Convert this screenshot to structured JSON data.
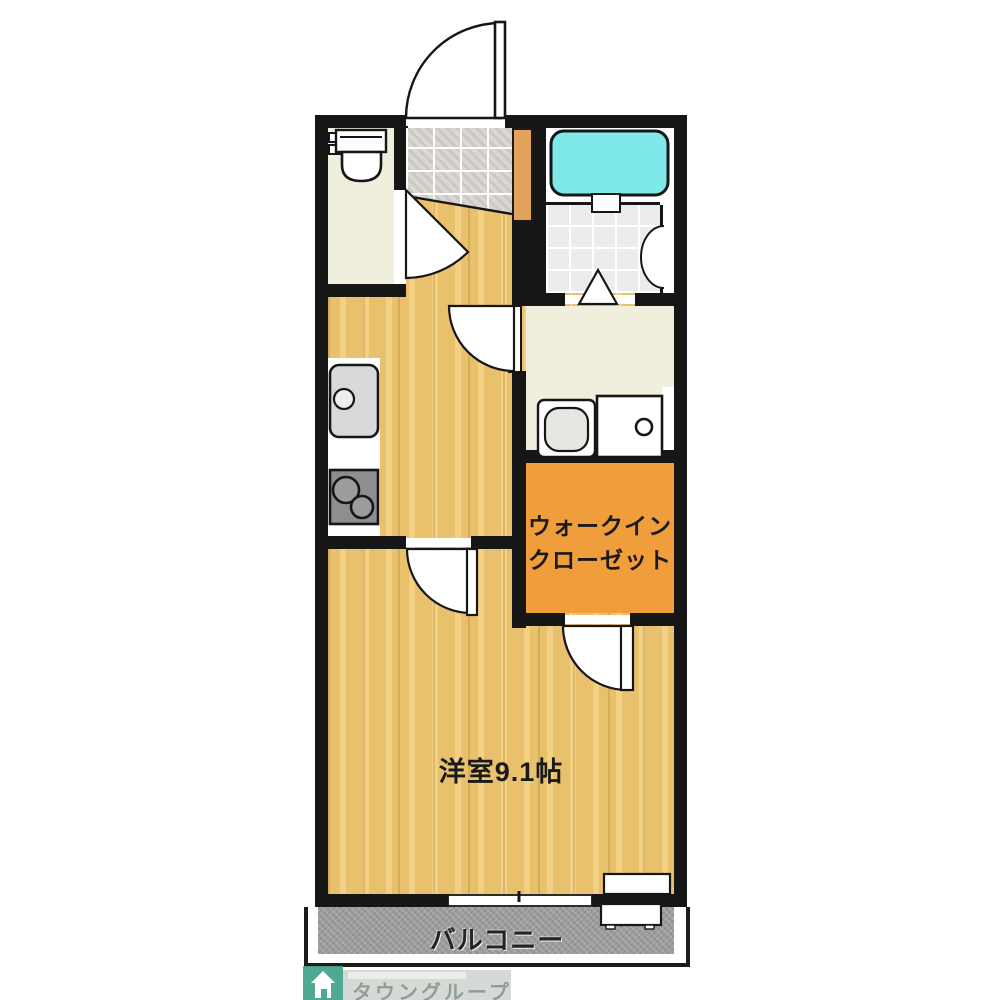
{
  "plan": {
    "type": "japanese-apartment-floorplan",
    "rooms": {
      "main_room": {
        "label": "洋室9.1帖"
      },
      "walk_in_closet": {
        "label_line1": "ウォークイン",
        "label_line2": "クローゼット"
      },
      "balcony": {
        "label": "バルコニー"
      },
      "toilet": {
        "icon": "toilet-icon"
      },
      "bathroom": {
        "icons": [
          "bathtub-icon",
          "folding-door-icon"
        ]
      },
      "washroom": {
        "icons": [
          "washbasin-icon",
          "washing-machine-pan-icon"
        ]
      },
      "kitchen": {
        "icons": [
          "sink-icon",
          "two-burner-stove-icon"
        ]
      },
      "entrance": {
        "icons": [
          "entrance-door-swing-icon"
        ]
      }
    },
    "fixtures": {
      "window": "sliding-window",
      "ac_outdoor_unit": "outdoor-unit-icon"
    },
    "colors": {
      "wall": "#161616",
      "wood_floor": "#e9c06b",
      "tile_floor": "#dbd8d3",
      "cream_floor": "#f0eedc",
      "closet_orange": "#f09d3c",
      "entrance_step_orange": "#e2a25b",
      "bathtub_cyan": "#7fe9e9",
      "balcony_gray": "#9c9c9c",
      "logo_teal": "#40a289"
    },
    "watermark": {
      "brand": "タウングループ",
      "icon": "house-icon"
    }
  }
}
